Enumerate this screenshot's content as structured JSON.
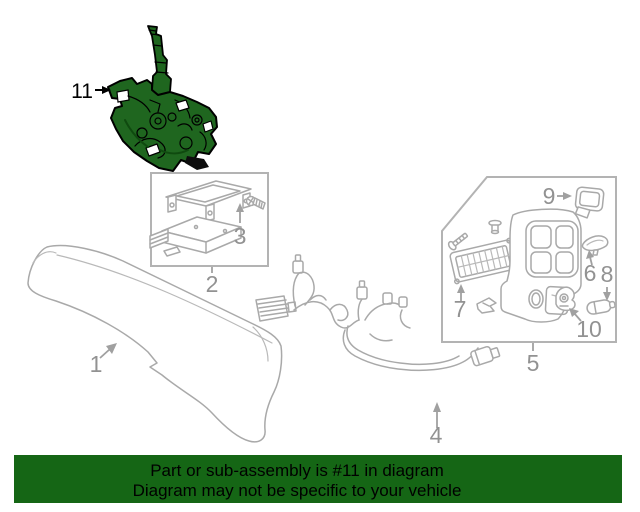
{
  "diagram": {
    "callouts": {
      "c1": {
        "label": "1"
      },
      "c2": {
        "label": "2"
      },
      "c3": {
        "label": "3"
      },
      "c4": {
        "label": "4"
      },
      "c5": {
        "label": "5"
      },
      "c6": {
        "label": "6"
      },
      "c7": {
        "label": "7"
      },
      "c8": {
        "label": "8"
      },
      "c9": {
        "label": "9"
      },
      "c10": {
        "label": "10"
      },
      "c11": {
        "label": "11"
      }
    },
    "highlighted_part": "11",
    "colors": {
      "line_gray": "#a9a9a9",
      "label_gray": "#929292",
      "highlight_green": "#1f661f",
      "outline_black": "#000000",
      "background": "#ffffff"
    }
  },
  "banner": {
    "line1": "Part or sub-assembly is #11 in diagram",
    "line2": "Diagram may not be specific to your vehicle",
    "background_color": "#156615",
    "text_color": "#000000"
  }
}
